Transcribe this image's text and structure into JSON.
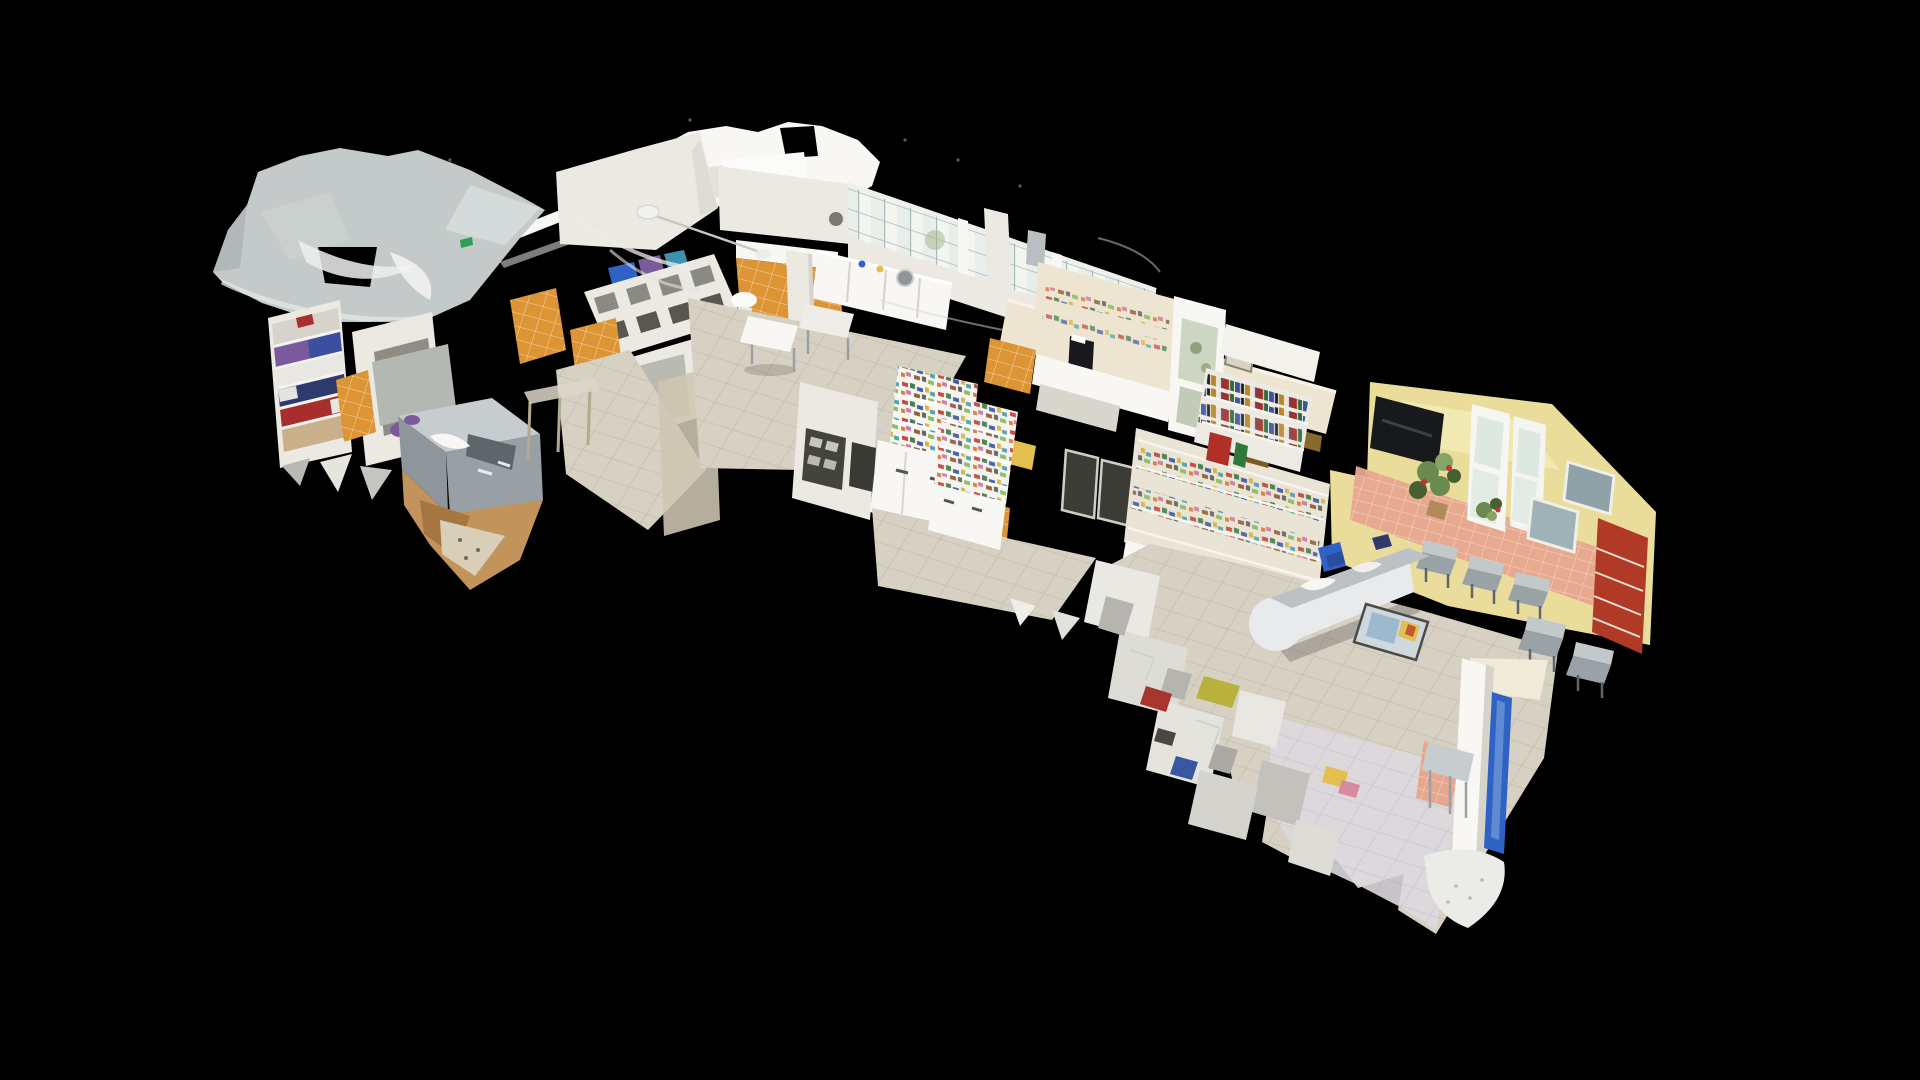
{
  "scene": {
    "view_mode": "dollhouse-3d-cutaway",
    "subject": "veterinary-clinic-point-cloud-model",
    "background_color": "#000000",
    "palette": {
      "roof_gray": "#c4cac9",
      "roof_gray_light": "#dde2e1",
      "roof_gray_dark": "#b2b8ba",
      "wall_white": "#ece9e2",
      "wall_bright": "#f8f7f4",
      "wall_shade": "#d6d3ca",
      "wall_cream": "#ede5d2",
      "wall_warm": "#f0ead8",
      "tile_orange": "#dd9434",
      "tile_orange_grout": "#f0d8ae",
      "tile_salmon": "#e7a78f",
      "tile_salmon_grout": "#f4d5c8",
      "window_pane": "#f3f5ef",
      "window_cool": "#dde8e3",
      "window_mullion": "#a9b6b6",
      "floor_beige": "#d7d1c3",
      "floor_grout": "#c3bcac",
      "floor_lavender": "#dcd9df",
      "floor_lavender_grout": "#c9c6cd",
      "steel": "#99a0a5",
      "steel_dark": "#5f666b",
      "steel_light": "#c7cccf",
      "yellow_wall": "#eadd9c",
      "yellow_wall_lit": "#f4eebb",
      "tv_black": "#17191c",
      "red_cabinet": "#b13a27",
      "plant_green": "#6a8a50",
      "plant_green_dark": "#47602f",
      "plant_green_light": "#86a468",
      "flower_red": "#c03434",
      "chair_gray": "#c3c8cb",
      "chair_shade": "#9aa2a7",
      "chair_leg": "#5e666c",
      "accent_blue": "#2f62c4",
      "accent_blue_light": "#6b96d8",
      "mat_blue": "#9db9cf",
      "mat_yellow": "#e2bf4e",
      "mat_red": "#bf5a33",
      "linen_red": "#a82e2e",
      "linen_blue": "#3a4f9f",
      "linen_purple": "#7a5a9d",
      "linen_navy": "#2e3a6e",
      "tan_debris": "#c3935c",
      "tan_debris_dark": "#a5763f",
      "exit_green": "#2f9e57",
      "glass_beige": "#cfc6b2",
      "gold_sign": "#8a6a2a",
      "photo_gray": "#9fb2b8",
      "poster_dark": "#44443e",
      "cage_opening": "#8a8a84",
      "cage_opening_dark": "#57574f",
      "void_black": "#000000"
    }
  }
}
